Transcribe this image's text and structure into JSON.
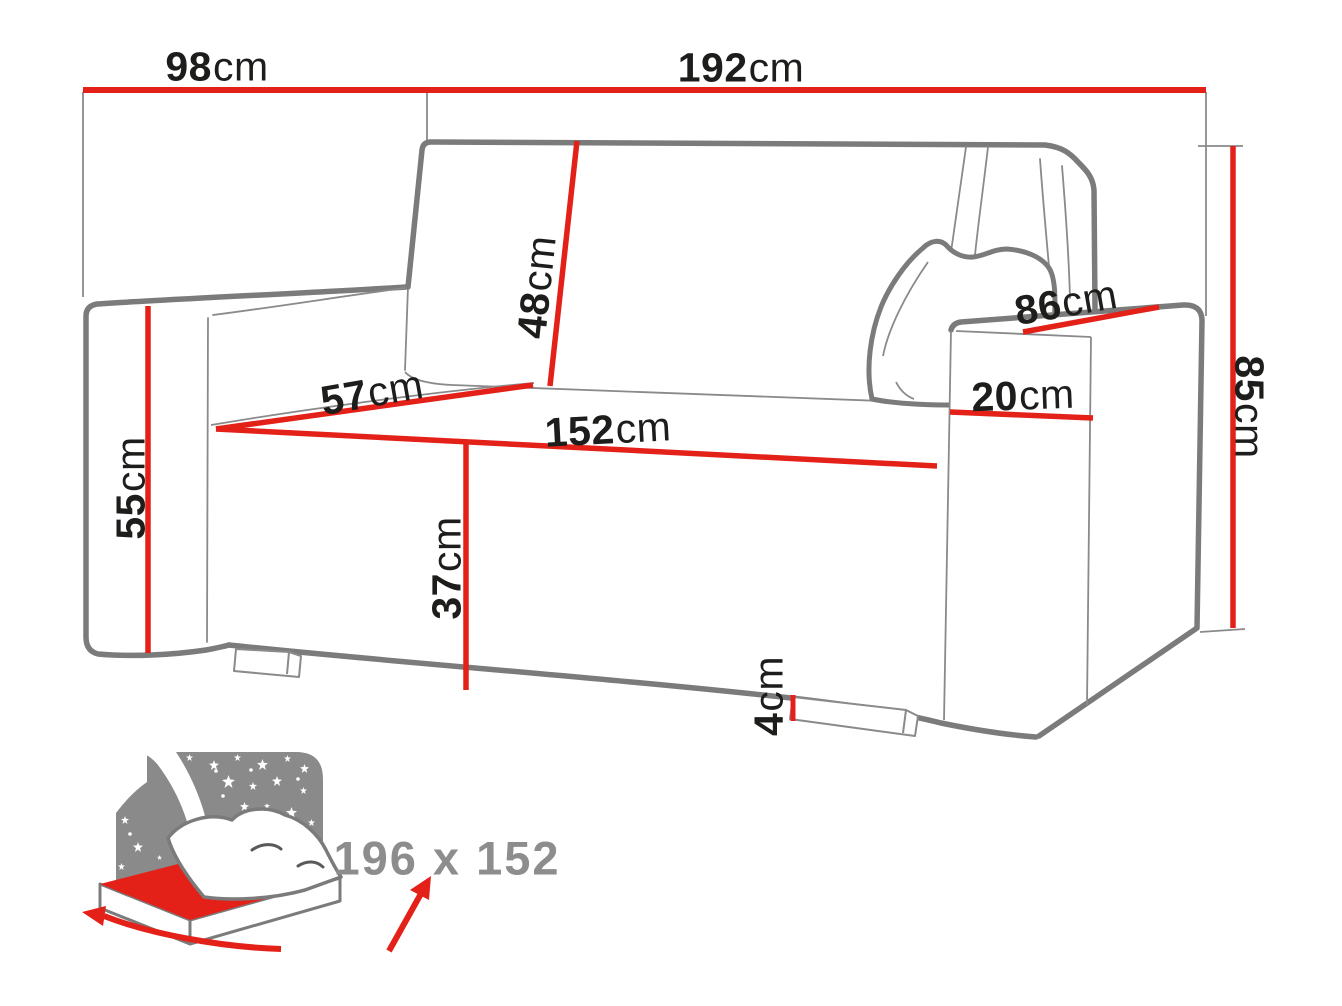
{
  "colors": {
    "dimension_red": "#e32119",
    "outline_gray": "#7b7b7b",
    "thin_gray": "#8a8a8a",
    "label_black": "#1d1d1b",
    "icon_gray": "#8a8a8a",
    "icon_text_gray": "#8d8d8d",
    "background": "#ffffff"
  },
  "diagram": {
    "title": "sofa-bed-dimension-diagram",
    "dimensions": [
      {
        "name": "overall-depth",
        "value": "98",
        "unit": "cm"
      },
      {
        "name": "overall-width",
        "value": "192",
        "unit": "cm"
      },
      {
        "name": "backrest-height",
        "value": "48",
        "unit": "cm"
      },
      {
        "name": "seat-depth",
        "value": "57",
        "unit": "cm"
      },
      {
        "name": "seat-width",
        "value": "152",
        "unit": "cm"
      },
      {
        "name": "armrest-height",
        "value": "55",
        "unit": "cm"
      },
      {
        "name": "seat-height",
        "value": "37",
        "unit": "cm"
      },
      {
        "name": "leg-height",
        "value": "4",
        "unit": "cm"
      },
      {
        "name": "armrest-depth",
        "value": "86",
        "unit": "cm"
      },
      {
        "name": "armrest-width",
        "value": "20",
        "unit": "cm"
      },
      {
        "name": "overall-height",
        "value": "85",
        "unit": "cm"
      }
    ],
    "sleeping_area": {
      "label": "196 x 152"
    }
  }
}
